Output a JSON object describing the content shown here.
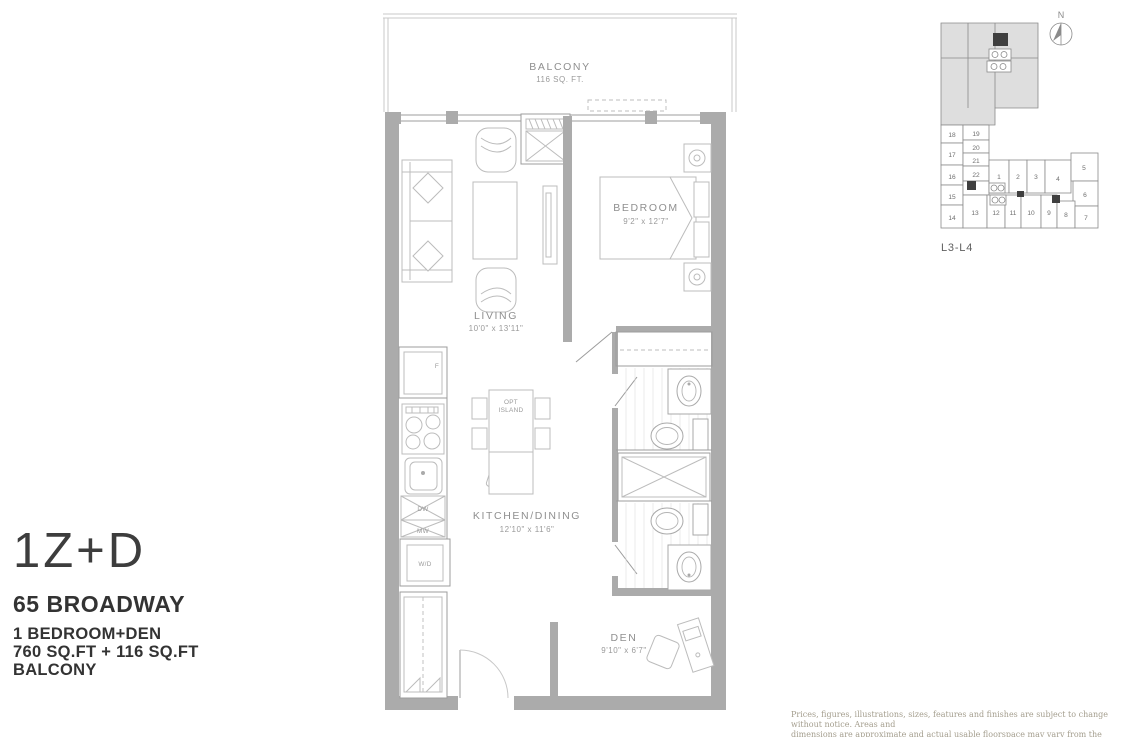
{
  "title_block": {
    "unit_code": "1Z+D",
    "project": "65 BROADWAY",
    "type": "1 BEDROOM+DEN",
    "area": "760 SQ.FT + 116 SQ.FT",
    "extra": "BALCONY"
  },
  "plan": {
    "balcony": {
      "name": "BALCONY",
      "area": "116 SQ. FT."
    },
    "living": {
      "name": "LIVING",
      "dims": "10'0\" x 13'11\""
    },
    "bedroom": {
      "name": "BEDROOM",
      "dims": "9'2\" x 12'7\""
    },
    "kitchen": {
      "name": "KITCHEN/DINING",
      "dims": "12'10\" x 11'6\""
    },
    "den": {
      "name": "DEN",
      "dims": "9'10\" x 6'7\""
    },
    "island": {
      "line1": "OPT",
      "line2": "ISLAND"
    },
    "appliances": {
      "fridge": "F",
      "dishwasher": "DW",
      "microwave": "MW",
      "washer_dryer": "W/D"
    }
  },
  "keyplan": {
    "north": "N",
    "level": "L3-L4",
    "highlighted_unit": "10",
    "units": [
      "1",
      "2",
      "3",
      "4",
      "5",
      "6",
      "7",
      "8",
      "9",
      "10",
      "11",
      "12",
      "13",
      "14",
      "15",
      "16",
      "17",
      "18",
      "19",
      "20",
      "21",
      "22"
    ]
  },
  "disclaimer": {
    "line1": "Prices, figures, illustrations, sizes, features and finishes are subject to change without notice.  Areas and",
    "line2": "dimensions are approximate and actual usable floorspace may vary from the stated area.  E. & O. E. July 2019"
  },
  "colors": {
    "keyplan_highlight": "#b9b9b9",
    "wall_gray": "#ababab"
  }
}
